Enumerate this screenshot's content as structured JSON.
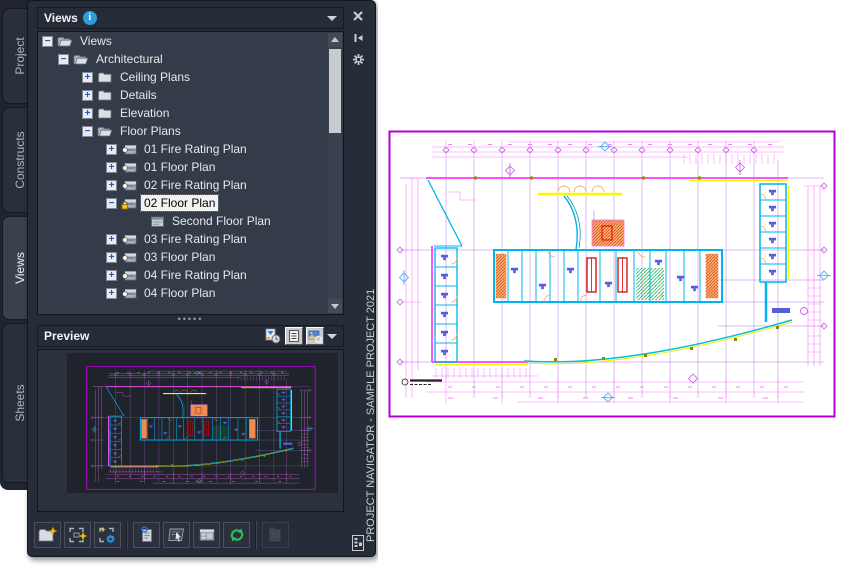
{
  "palette": {
    "title": "Views",
    "vertical_label": "PROJECT NAVIGATOR - SAMPLE PROJECT 2021",
    "tabs": [
      {
        "label": "Project",
        "active": false
      },
      {
        "label": "Constructs",
        "active": false
      },
      {
        "label": "Views",
        "active": true
      },
      {
        "label": "Sheets",
        "active": false
      }
    ],
    "titlebar_icons": [
      "info-icon",
      "dropdown-caret-icon"
    ],
    "right_strip_icons": [
      "close-icon",
      "auto-hide-pin-icon",
      "properties-gear-icon",
      "palette-mini-icon"
    ],
    "tree": {
      "items": [
        {
          "label": "Views",
          "level": 0,
          "expander": "minus",
          "icon": "folder-open",
          "selected": false
        },
        {
          "label": "Architectural",
          "level": 1,
          "expander": "minus",
          "icon": "folder-open",
          "selected": false
        },
        {
          "label": "Ceiling Plans",
          "level": 2,
          "expander": "plus",
          "icon": "folder",
          "selected": false
        },
        {
          "label": "Details",
          "level": 2,
          "expander": "plus",
          "icon": "folder",
          "selected": false
        },
        {
          "label": "Elevation",
          "level": 2,
          "expander": "plus",
          "icon": "folder",
          "selected": false
        },
        {
          "label": "Floor Plans",
          "level": 2,
          "expander": "minus",
          "icon": "folder-open",
          "selected": false
        },
        {
          "label": "01 Fire Rating Plan",
          "level": 3,
          "expander": "plus",
          "icon": "view",
          "selected": false
        },
        {
          "label": "01 Floor Plan",
          "level": 3,
          "expander": "plus",
          "icon": "view",
          "selected": false
        },
        {
          "label": "02 Fire Rating Plan",
          "level": 3,
          "expander": "plus",
          "icon": "view",
          "selected": false
        },
        {
          "label": "02 Floor Plan",
          "level": 3,
          "expander": "minus",
          "icon": "view-locked",
          "selected": true
        },
        {
          "label": "Second Floor Plan",
          "level": 4,
          "expander": "none",
          "icon": "sheet",
          "selected": false
        },
        {
          "label": "03 Fire Rating Plan",
          "level": 3,
          "expander": "plus",
          "icon": "view",
          "selected": false
        },
        {
          "label": "03 Floor Plan",
          "level": 3,
          "expander": "plus",
          "icon": "view",
          "selected": false
        },
        {
          "label": "04 Fire Rating Plan",
          "level": 3,
          "expander": "plus",
          "icon": "view",
          "selected": false
        },
        {
          "label": "04 Floor Plan",
          "level": 3,
          "expander": "plus",
          "icon": "view",
          "selected": false
        }
      ]
    },
    "splitter_dots": "•••••",
    "preview": {
      "label": "Preview"
    },
    "preview_icons": [
      "preview-clock-icon",
      "details-list-icon",
      "preview-image-icon",
      "dropdown-caret-icon"
    ],
    "toolbar_icons": [
      "folder-star-icon",
      "selection-star-icon",
      "selection-gear-icon",
      "document-clip-icon",
      "board-cursor-icon",
      "panel-grid-icon",
      "refresh-arrows-icon",
      "panel-clip-disabled-icon"
    ]
  },
  "drawing": {
    "colors": {
      "border": "#b400d8",
      "dimension_pink": "#ff7dff",
      "grid_purple": "#b878e8",
      "wall_cyan": "#00b4f0",
      "curve_teal": "#00c0cc",
      "fixture_blue": "#5560d8",
      "stair_orange": "#e05818",
      "elevator_red": "#e00000",
      "accent_yellow": "#f8f800",
      "hatch_green": "#00a848",
      "marker_blue": "#58b0f0"
    }
  }
}
